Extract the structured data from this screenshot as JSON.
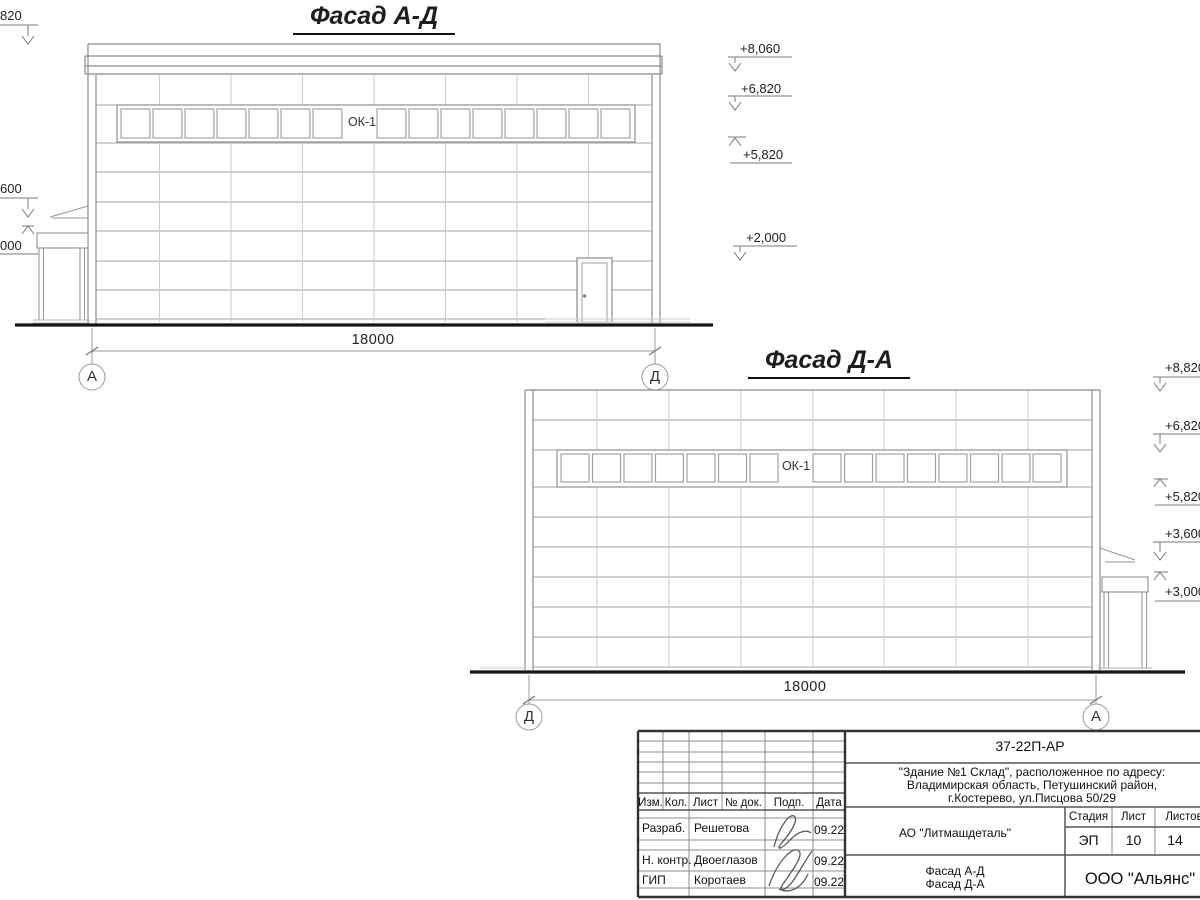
{
  "facade1": {
    "title": "Фасад А-Д",
    "window_label": "ОК-1",
    "dimension": "18000",
    "axis_left": "А",
    "axis_right": "Д",
    "marks_left": [
      "820",
      "600",
      "000"
    ],
    "marks_right": [
      "+8,060",
      "+6,820",
      "+5,820",
      "+2,000"
    ]
  },
  "facade2": {
    "title": "Фасад Д-А",
    "window_label": "ОК-1",
    "dimension": "18000",
    "axis_left": "Д",
    "axis_right": "А",
    "marks_right": [
      "+8,820",
      "+6,820",
      "+5,820",
      "+3,600",
      "+3,000"
    ]
  },
  "titleblock": {
    "doc_number": "37-22П-АР",
    "address_line1": "\"Здание №1 Склад\", расположенное по адресу:",
    "address_line2": "Владимирская область, Петушинский район,",
    "address_line3": "г.Костерево, ул.Писцова 50/29",
    "company": "АО \"Литмашдеталь\"",
    "stage_label": "Стадия",
    "sheet_label": "Лист",
    "sheets_label": "Листов",
    "stage_value": "ЭП",
    "sheet_value": "10",
    "sheets_value": "14",
    "sheet_title_line1": "Фасад А-Д",
    "sheet_title_line2": "Фасад Д-А",
    "org": "ООО \"Альянс\"",
    "header": {
      "izm": "Изм.",
      "kol": "Кол.",
      "list": "Лист",
      "doc": "№ док.",
      "podp": "Подп.",
      "data": "Дата"
    },
    "rows": [
      {
        "role": "Разраб.",
        "name": "Решетова",
        "date": "09.22"
      },
      {
        "role": "Н. контр.",
        "name": "Двоеглазов",
        "date": "09.22"
      },
      {
        "role": "ГИП",
        "name": "Коротаев",
        "date": "09.22"
      }
    ]
  }
}
